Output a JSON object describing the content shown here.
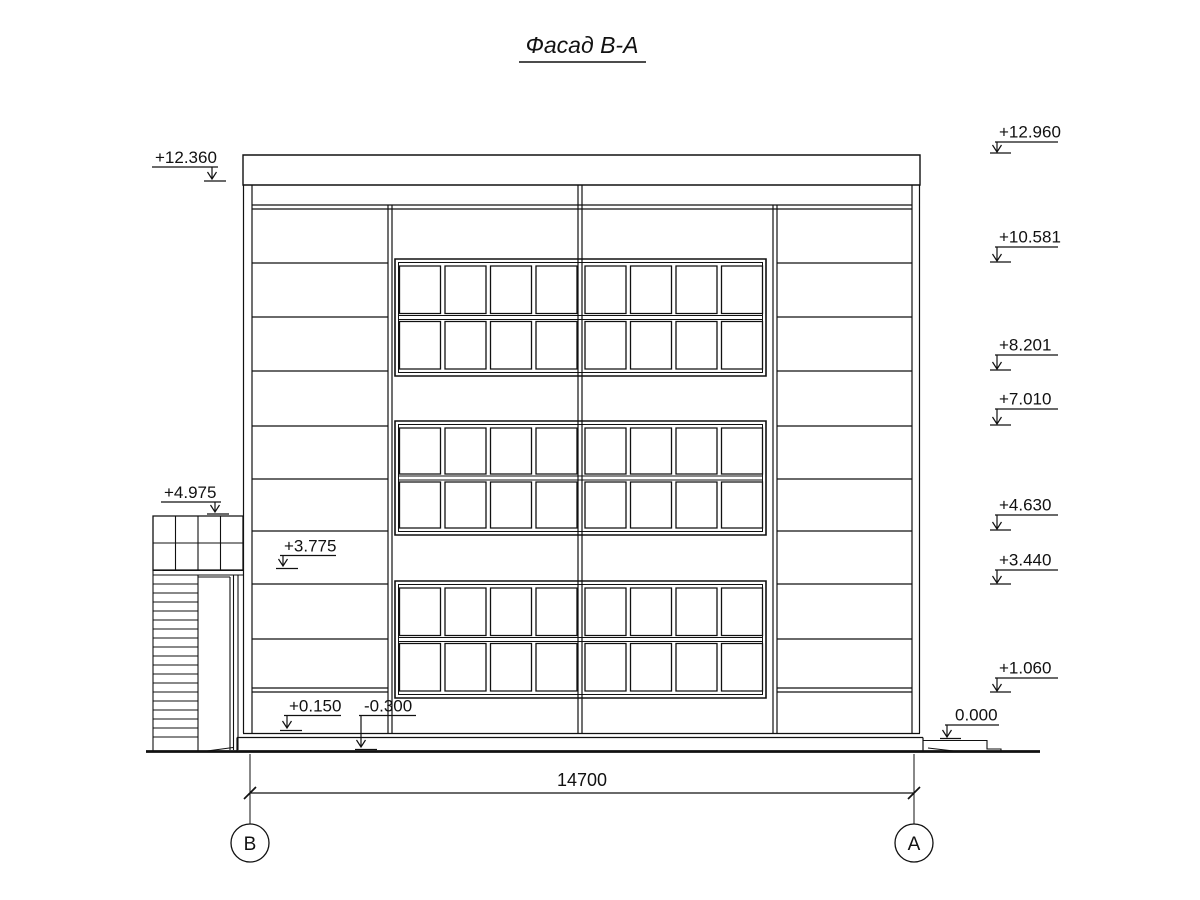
{
  "title": "Фасад В-А",
  "elevation_marks": {
    "left": [
      "+12.360",
      "+4.975",
      "+3.775",
      "+0.150",
      "-0.300"
    ],
    "right": [
      "+12.960",
      "+10.581",
      "+8.201",
      "+7.010",
      "+4.630",
      "+3.440",
      "+1.060",
      "0.000"
    ]
  },
  "dimension": "14700",
  "axes": [
    "В",
    "А"
  ],
  "colors": {
    "line": "#111111",
    "background": "#ffffff"
  }
}
